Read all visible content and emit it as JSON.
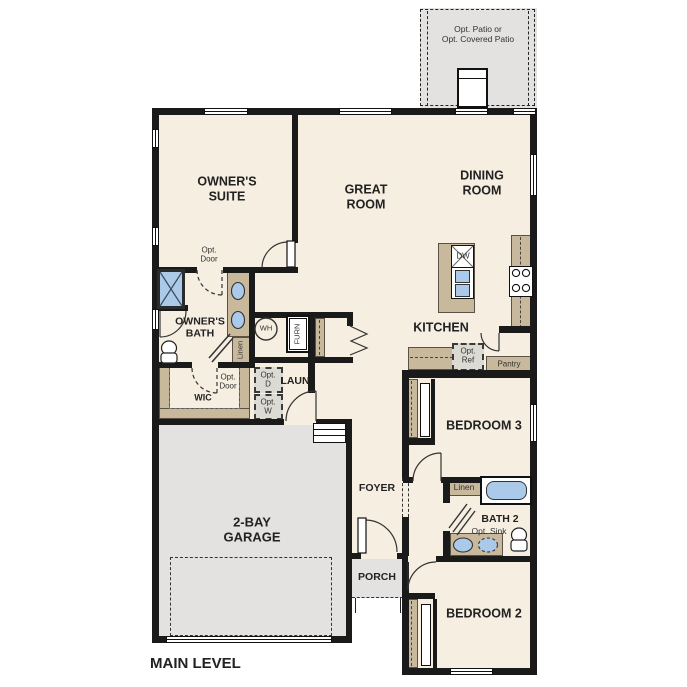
{
  "title": "MAIN LEVEL",
  "patio": {
    "label": "Opt. Patio or\nOpt. Covered Patio"
  },
  "rooms": {
    "owners_suite": "OWNER'S\nSUITE",
    "great_room": "GREAT\nROOM",
    "dining_room": "DINING\nROOM",
    "kitchen": "KITCHEN",
    "owners_bath": "OWNER'S\nBATH",
    "wic": "WIC",
    "laundry": "LAUN",
    "foyer": "FOYER",
    "porch": "PORCH",
    "garage": "2-BAY\nGARAGE",
    "bedroom_3": "BEDROOM 3",
    "bath_2": "BATH 2",
    "bedroom_2": "BEDROOM 2",
    "pantry": "Pantry"
  },
  "fixtures": {
    "water_heater": "WH",
    "furnace": "FURN",
    "dishwasher": "DW",
    "opt_dryer": "Opt.\nD",
    "opt_washer": "Opt.\nW",
    "opt_refrigerator": "Opt.\nRef",
    "opt_sink": "Opt. Sink",
    "linen": "Linen",
    "opt_door": "Opt.\nDoor"
  },
  "colors": {
    "wall": "#1a1a1a",
    "floor": "#f6eee1",
    "cabinet_tan": "#c8b89c",
    "concrete_gray": "#e3e2e0",
    "fixture_blue": "#abc9e8"
  }
}
